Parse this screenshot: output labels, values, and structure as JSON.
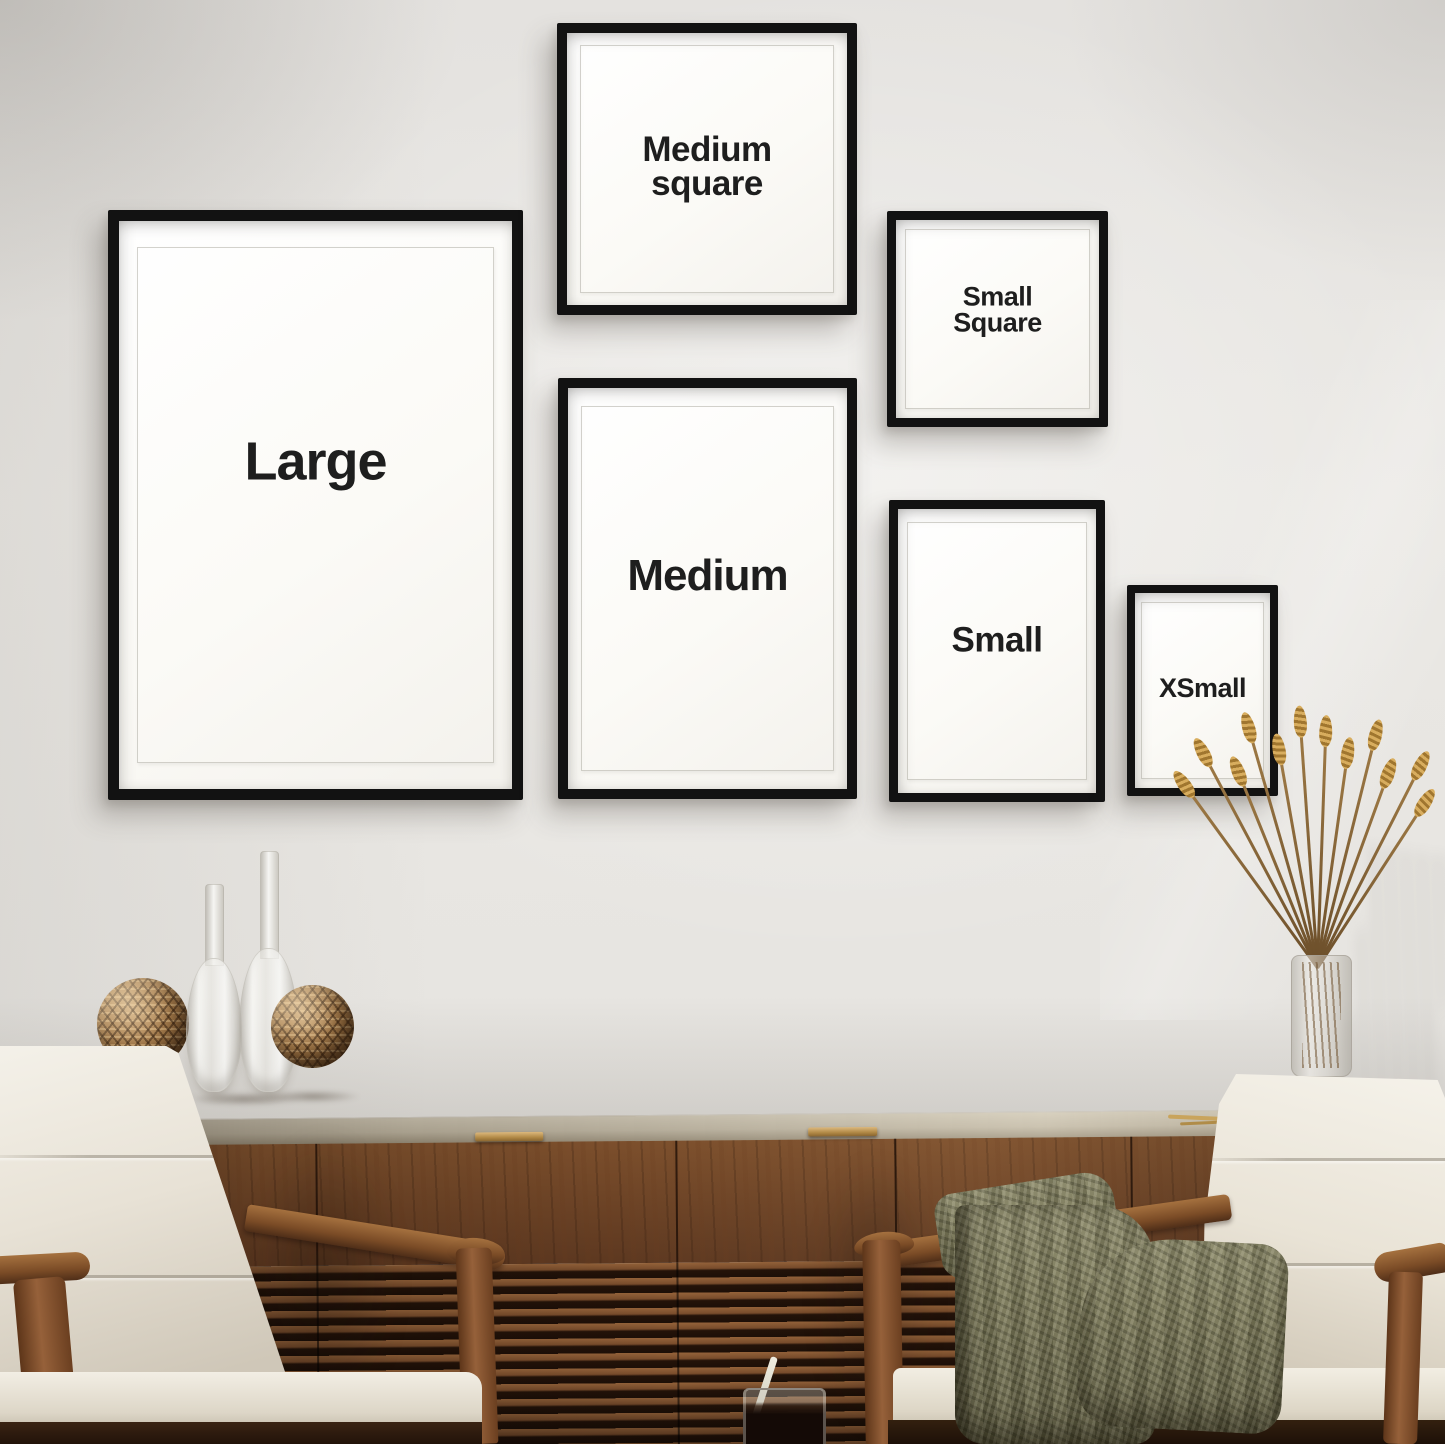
{
  "scene": {
    "description": "Gallery wall mockup showing six black poster frames in different sizes above a walnut slatted sideboard with two white armchairs and decor",
    "colors": {
      "wall": "#e6e4e1",
      "frame_black": "#121212",
      "mat_white": "#fbfaf6",
      "label_text": "#1e1e1e",
      "walnut": "#6b4225",
      "walnut_dark": "#241309",
      "countertop": "#bdb4a0",
      "brass_handle": "#b08845",
      "cushion": "#efebe1",
      "throw_olive": "#767455",
      "wheat_gold": "#c2964d",
      "rattan": "#9c7243"
    }
  },
  "frames": {
    "large": {
      "label": "Large"
    },
    "medium_square": {
      "label_line1": "Medium",
      "label_line2": "square"
    },
    "small_square": {
      "label_line1": "Small",
      "label_line2": "Square"
    },
    "medium": {
      "label": "Medium"
    },
    "small": {
      "label": "Small"
    },
    "xsmall": {
      "label": "XSmall"
    }
  },
  "objects": [
    "walnut-sideboard",
    "rattan-ball",
    "rattan-ball",
    "glass-teardrop-vase",
    "glass-teardrop-vase",
    "wheat-bouquet-in-glass-vase",
    "drink-glass-with-stirrer",
    "white-armchair-left",
    "white-armchair-right",
    "olive-knit-throw"
  ]
}
